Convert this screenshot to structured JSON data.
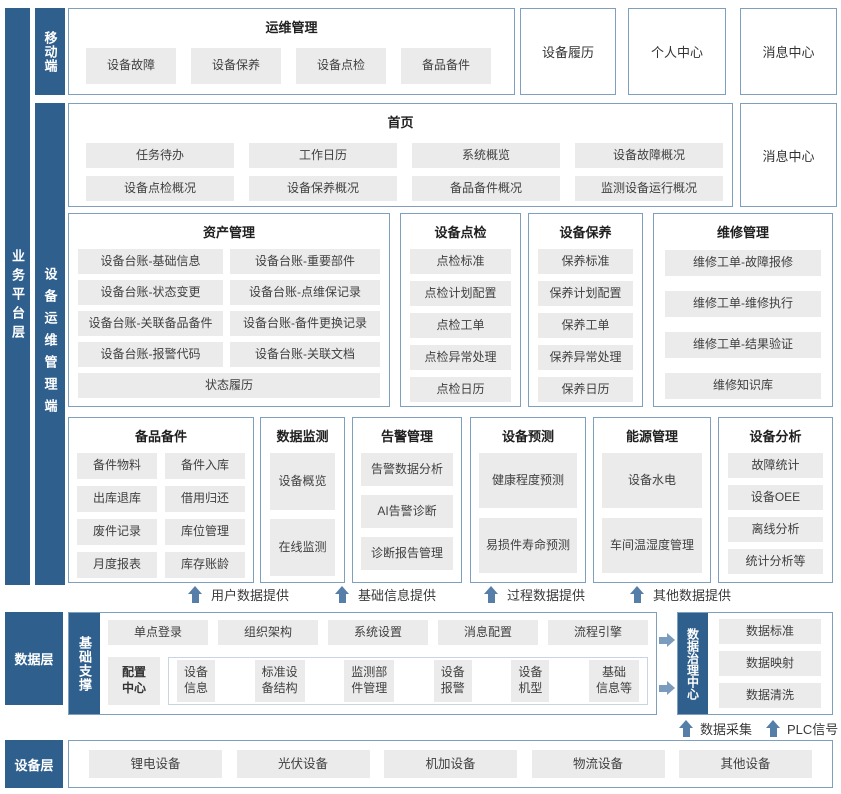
{
  "colors": {
    "rail_blue": "#2e5f8d",
    "box_border": "#7f9fbf",
    "item_bg": "#ebebeb",
    "arrow_blue": "#557fa9"
  },
  "rails": {
    "business": "业务平台层",
    "mobile": "移动端",
    "ops": "设备运维管理端"
  },
  "side_labels": {
    "data_layer": "数据层",
    "device_layer": "设备层"
  },
  "mobile_section": {
    "title": "运维管理",
    "items": [
      "设备故障",
      "设备保养",
      "设备点检",
      "备品备件"
    ]
  },
  "top_boxes": [
    "设备履历",
    "个人中心",
    "消息中心"
  ],
  "home_section": {
    "title": "首页",
    "items": [
      "任务待办",
      "工作日历",
      "系统概览",
      "设备故障概况",
      "设备点检概况",
      "设备保养概况",
      "备品备件概况",
      "监测设备运行概况"
    ],
    "side_box": "消息中心"
  },
  "asset_section": {
    "title": "资产管理",
    "items": [
      "设备台账-基础信息",
      "设备台账-重要部件",
      "设备台账-状态变更",
      "设备台账-点维保记录",
      "设备台账-关联备品备件",
      "设备台账-备件更换记录",
      "设备台账-报警代码",
      "设备台账-关联文档"
    ],
    "full_item": "状态履历"
  },
  "inspection_section": {
    "title": "设备点检",
    "items": [
      "点检标准",
      "点检计划配置",
      "点检工单",
      "点检异常处理",
      "点检日历"
    ]
  },
  "maintenance_section": {
    "title": "设备保养",
    "items": [
      "保养标准",
      "保养计划配置",
      "保养工单",
      "保养异常处理",
      "保养日历"
    ]
  },
  "repair_section": {
    "title": "维修管理",
    "items": [
      "维修工单-故障报修",
      "维修工单-维修执行",
      "维修工单-结果验证",
      "维修知识库"
    ]
  },
  "spare_section": {
    "title": "备品备件",
    "items": [
      "备件物料",
      "备件入库",
      "出库退库",
      "借用归还",
      "废件记录",
      "库位管理",
      "月度报表",
      "库存账龄"
    ]
  },
  "monitor_section": {
    "title": "数据监测",
    "items": [
      "设备概览",
      "在线监测"
    ]
  },
  "alarm_section": {
    "title": "告警管理",
    "items": [
      "告警数据分析",
      "AI告警诊断",
      "诊断报告管理"
    ]
  },
  "predict_section": {
    "title": "设备预测",
    "items": [
      "健康程度预测",
      "易损件寿命预测"
    ]
  },
  "energy_section": {
    "title": "能源管理",
    "items": [
      "设备水电",
      "车间温湿度管理"
    ]
  },
  "analysis_section": {
    "title": "设备分析",
    "items": [
      "故障统计",
      "设备OEE",
      "离线分析",
      "统计分析等"
    ]
  },
  "flow_arrows": [
    "用户数据提供",
    "基础信息提供",
    "过程数据提供",
    "其他数据提供"
  ],
  "data_layer": {
    "support_label": "基础支撑",
    "platform_items": [
      "单点登录",
      "组织架构",
      "系统设置",
      "消息配置",
      "流程引擎"
    ],
    "config_center": "配置\n中心",
    "config_items": [
      "设备\n信息",
      "标准设\n备结构",
      "监测部\n件管理",
      "设备\n报警",
      "设备\n机型",
      "基础\n信息等"
    ],
    "governance_label": "数据治理中心",
    "governance_items": [
      "数据标准",
      "数据映射",
      "数据清洗"
    ],
    "bottom_arrows": [
      "数据采集",
      "PLC信号"
    ]
  },
  "device_layer": {
    "items": [
      "锂电设备",
      "光伏设备",
      "机加设备",
      "物流设备",
      "其他设备"
    ]
  }
}
